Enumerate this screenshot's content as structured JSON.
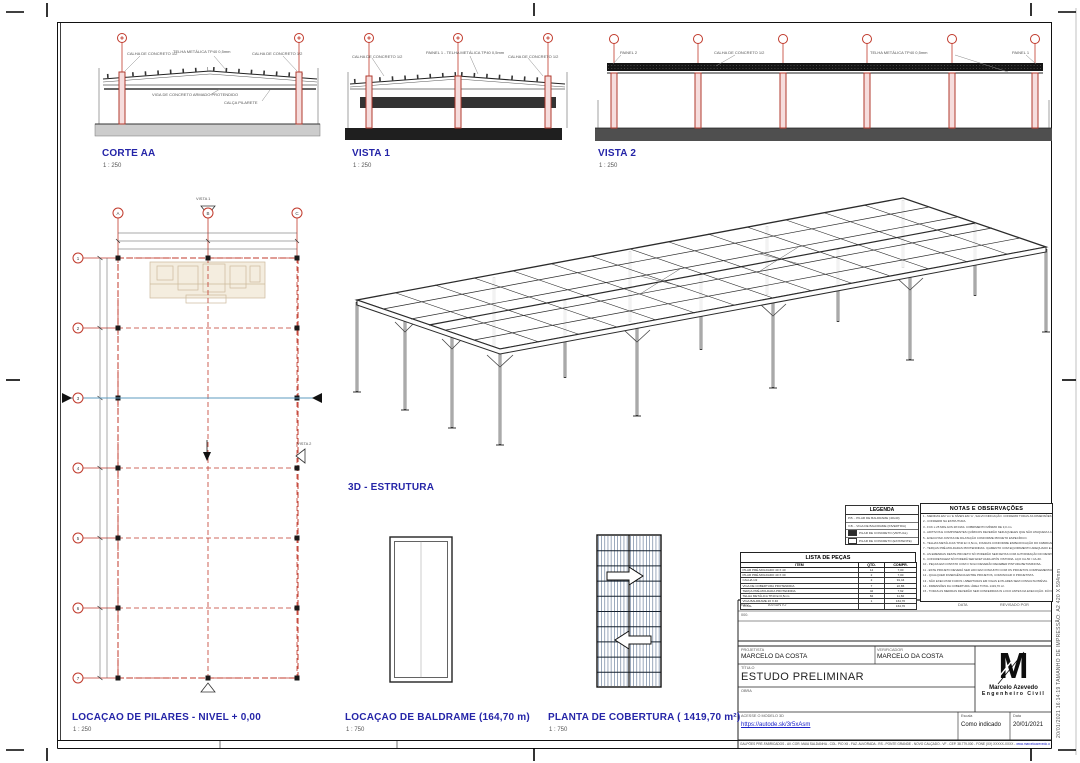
{
  "margin": {
    "print_note": "20/01/2021 16:14:19        TAMANHO DE IMPRESSÃO:  A2 420 X 594mm"
  },
  "views": {
    "corte_aa": {
      "title": "CORTE AA",
      "scale": "1 : 250"
    },
    "vista_1": {
      "title": "VISTA 1",
      "scale": "1 : 250"
    },
    "vista_2": {
      "title": "VISTA 2",
      "scale": "1 : 250"
    },
    "estrutura_3d": {
      "title": "3D  - ESTRUTURA"
    },
    "pilares": {
      "title": "LOCAÇAO DE PILARES - NIVEL + 0,00",
      "scale": "1 : 250"
    },
    "baldrame": {
      "title": "LOCAÇAO DE BALDRAME (164,70 m)",
      "scale": "1 : 750"
    },
    "cobertura": {
      "title": "PLANTA DE COBERTURA ( 1419,70 m²)",
      "scale": "1 : 750"
    }
  },
  "annotations": {
    "calha": "CALHA DE CONCRETO 1/2",
    "telha": "TELHA METÁLICA TP40 0,5mm",
    "painel_telha": "PAINEL 1 - TELHA METÁLICA TP40 0,5mm",
    "painel_1": "PAINEL 1",
    "painel_2": "PAINEL 2",
    "viga_protendida": "VIGA DE CONCRETO ARMADO PROTENDIDO",
    "calca_pilarete": "CALÇA PILARETE",
    "vista1_marker": "VISTA 1",
    "vista2_marker": "VISTA 2"
  },
  "grid": {
    "top": [
      "A",
      "B",
      "C"
    ],
    "left": [
      "1",
      "2",
      "3",
      "4",
      "5",
      "6",
      "7"
    ]
  },
  "legenda": {
    "title": "LEGENDA",
    "rows": [
      "P.B. - PILAR DE BALDRAME (40x40)",
      "V.B. - VIGA DE BALDRAME (INVERTIDA)",
      "PILAR DE CONCRETO (VIRTUAL)",
      "PILAR DE CONCRETO (EXISTENTE)"
    ]
  },
  "notas": {
    "title": "NOTAS E OBSERVAÇÕES",
    "lines": [
      "1 -  MEDIDAS EM 'cm' E NÍVEIS EM 'm', SALVO INDICAÇÃO. CONFERIR TODAS AS DIMENSÕES NA OBRA.",
      "2 -  CONFERIR NA ESTRUTURA.",
      "3 -  FCK ≥ 25 MPa AOS 28 DIAS. COBRIMENTO MÍNIMO DE 3,0 cm.",
      "4 -  ADITIVOS E COMPONENTES QUÍMICOS DEVERÃO SER AQUELES QUE NÃO ATAQUEM A ARMADURA.",
      "5 -  EXECUTAR JUNTAS DE DILATAÇÃO CONFORME PROJETO ESPECÍFICO.",
      "6 -  TELHAS METÁLICAS TP40 E= 0,5mm, FIXADAS CONFORME ESPECIFICAÇÃO DO FABRICANTE.",
      "7 -  TERÇAS PRÉ-MOLDADAS PROTENDIDAS. IÇAMENTO COM EQUIPAMENTO ADEQUADO E APOIO TÉCNICO.",
      "8 -  AS EMENDAS DESTE PROJETO SÓ PODERÃO SER FEITAS COM AUTORIZAÇÃO DO RESPONSÁVEL TÉCNICO.",
      "9 -  CONCRETAGEM SÓ PODERÁ SER EFETUADA APÓS VISTORIA. AÇO CA-50 / CA-60.",
      "10 - PEÇAS EM CONTATO COM O SOLO DEVERÃO RECEBER PINTURA BETUMINOSA.",
      "11 - ESTE PROJETO DEVERÁ SER LIDO EM CONJUNTO COM OS PROJETOS COMPLEMENTARES.",
      "12 - QUALQUER DIVERGÊNCIA ENTRE PROJETOS, COMUNICAR O PROJETISTA.",
      "13 - NÃO EXECUTAR FUROS / ABERTURAS EM VIGAS E PILARES SEM CONSULTA PRÉVIA.",
      "14 - DIMENSÕES DA COBERTURA: ÁREA TOTAL 1419,70 m².",
      "15 - TODAS AS MEDIDAS DEVERÃO SER CONFERIDAS IN LOCO ANTES DA EXECUÇÃO. DÚVIDAS, CONSULTAR O AUTOR."
    ]
  },
  "lista": {
    "title": "LISTA DE PEÇAS",
    "headers": [
      "ITEM",
      "QTD.",
      "COMPR."
    ],
    "rows": [
      [
        "PILAR PRÉ-MOLDADO 40 X 40",
        "14",
        "7,00"
      ],
      [
        "PILAR PRÉ-MOLDADO 40 X 30",
        "2",
        "7,00"
      ],
      [
        "CALHA 1/2",
        "2",
        "91,44"
      ],
      [
        "VIGA DE COBERTURA PROTENDIDA",
        "7",
        "22,86"
      ],
      [
        "TERÇA PRÉ-MOLDADA PROTENDIDA",
        "42",
        "7,62"
      ],
      [
        "TELHA METÁLICA TP40 E=0,5mm",
        "84",
        "11,60"
      ],
      [
        "VIGA BALDRAME 20 X 40",
        "1",
        "164,70"
      ],
      [
        "TOTAL",
        "",
        "164,70"
      ]
    ]
  },
  "titleblock": {
    "rev_label": "REV.",
    "assunto_label": "ASSUNTO",
    "data_col_label": "DATA",
    "revisado_label": "REVISADO POR",
    "rev_num": "000.",
    "projetista_label": "PROJETISTA",
    "projetista": "MARCELO DA COSTA",
    "verificador_label": "VERIFICADOR",
    "verificador": "MARCELO DA COSTA",
    "titulo_label": "TÍTULO",
    "titulo": "ESTUDO PRELIMINAR",
    "obra_label": "OBRA",
    "link_label": "ACESSE O MODELO 3D",
    "link_url": "https://autode.sk/3r5xAsm",
    "escala_label": "Escala",
    "escala_value": "Como indicado",
    "data_label": "Data",
    "data_value": "20/01/2021",
    "logo_letter": "M",
    "logo_name": "Marcelo Azevedo",
    "logo_role": "Engenheiro Civil",
    "address": "GALPÕES PRÉ-FABRICADOS - AV. COR. MAIA SALDANHA - COL. PIO XII - FAZ. ALVORADA - RS - PONTE GRANDE - NOVO CALÇADO - VF - CEP. 38.779-000 - FONE (XX) XXXXX-XXXX - ",
    "address_link": "www.marceloazevedo.com.br"
  },
  "colors": {
    "accent_blue": "#2525a8",
    "grid_red": "#c0392b",
    "link_blue": "#1a21c9"
  }
}
